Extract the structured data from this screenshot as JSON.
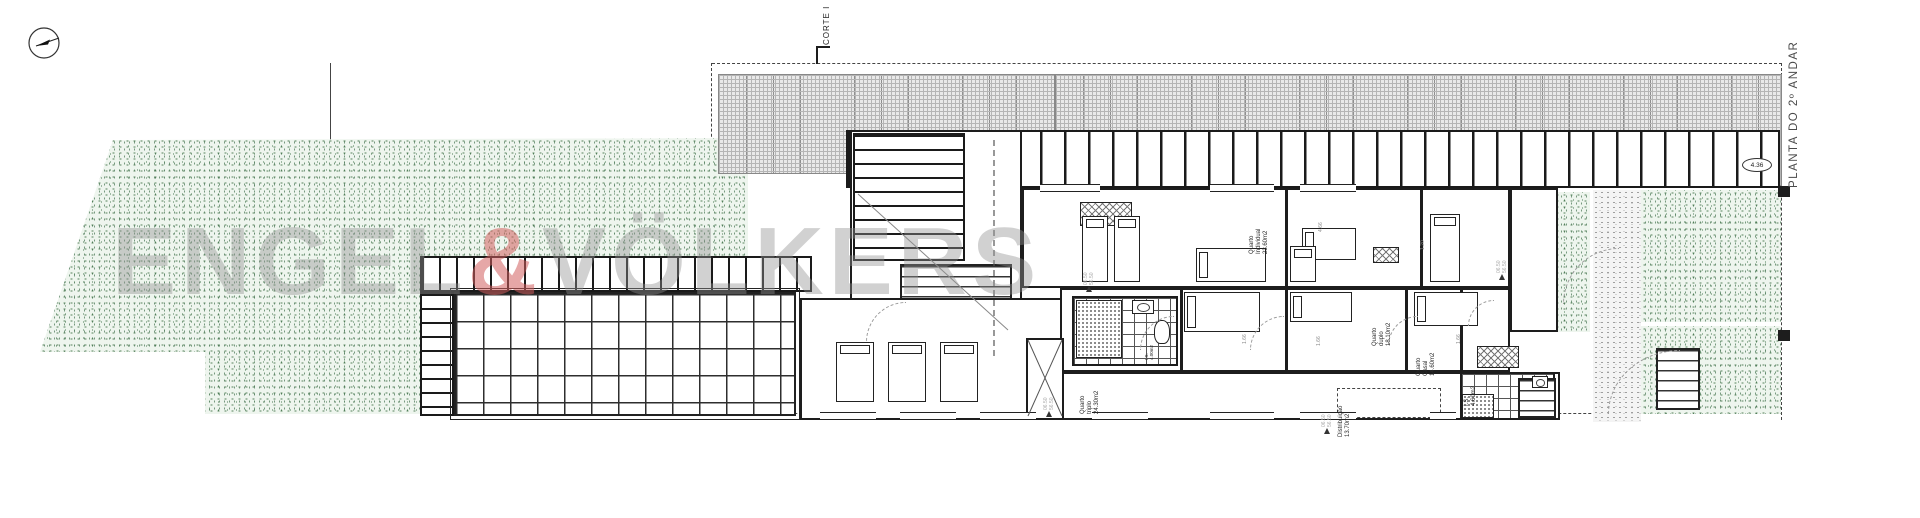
{
  "plan": {
    "title": "PLANTA DO 2º ANDAR",
    "section_label": "CORTE I"
  },
  "watermark": {
    "part1": "ENGEL",
    "amp": "&",
    "part2": "VÖLKERS"
  },
  "rooms": [
    {
      "line1": "Quarto",
      "line2": "Individual",
      "area": "23.60m2"
    },
    {
      "line1": "Quarto",
      "line2": "duplo",
      "area": "18.10m2"
    },
    {
      "line1": "Quarto",
      "line2": "Casal",
      "area": "14.60m2"
    },
    {
      "line1": "Quarto",
      "line2": "triplo",
      "area": "24.30m2"
    },
    {
      "line1": "Distribuição",
      "area": "13.70m2"
    },
    {
      "line1": "I.S.",
      "area": "4.60m2"
    },
    {
      "line1": "I.S.",
      "area": "4.00m2"
    }
  ],
  "levels": {
    "upper": "06.50",
    "lower": "56.50"
  },
  "dimensions": {
    "roof_width": "4.36",
    "bed_length": "1.66",
    "wall_span": "4.66",
    "door_width": "1.20"
  },
  "icons": {
    "north_arrow": "compass circle with needle",
    "level_flag": "filled triangle marker"
  },
  "colors": {
    "vegetation_bg": "#eef5ee",
    "vegetation_dot": "#55815c",
    "gravel_dot": "#9b9b9b",
    "hatch_bg": "#e9e9e9",
    "wall": "#1d1d1d",
    "watermark_text": "rgba(145,145,145,0.42)",
    "watermark_amp": "rgba(210,95,95,0.55)"
  }
}
